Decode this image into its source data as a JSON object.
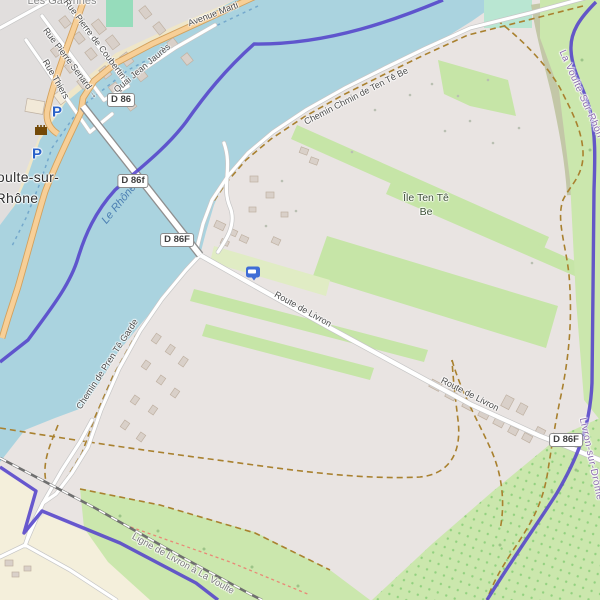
{
  "town": {
    "line1": "oulte-sur-",
    "line2": "Rhône"
  },
  "neighbourhood": "Les Garennes",
  "island": {
    "line1": "Île Ten Tê",
    "line2": "Be"
  },
  "river_label": "Le Rhône",
  "railway_label": "Ligne de Livron à La Voulte",
  "roads": {
    "avenue": "Avenue Marti",
    "quai": "Quai Jean Jaurès",
    "coubertin": "Rue Pierre de Coubertin",
    "senard": "Rue Pierre Senard",
    "thiers": "Rue Thiers",
    "chemin_ten": "Chemin Chmin de Ten Tê Be",
    "route_livron": "Route de Livron",
    "chemin_pren": "Chemin de Pren Tê Garde"
  },
  "badges": {
    "d86": "D 86",
    "d86f_lower": "D 86f",
    "d86f_bridge": "D 86F",
    "d86f_south": "D 86F"
  },
  "boundaries": {
    "voulte": "La Voulte-Sur-Rhôn",
    "livron": "Livron-sur-Drôme"
  },
  "poi": {
    "parking": "P",
    "oneway_arrow": "→"
  },
  "colors": {
    "water": "#aad3df",
    "meadow": "#c6e5a7",
    "boundary": "#5443cb",
    "primary_road": "#f7cf97",
    "residential": "#e1dedd",
    "farmland": "#e9e4e2",
    "farmland_cream": "#f4efdb",
    "parking_blue": "#2a62c9",
    "pitch": "#96dcbb"
  }
}
